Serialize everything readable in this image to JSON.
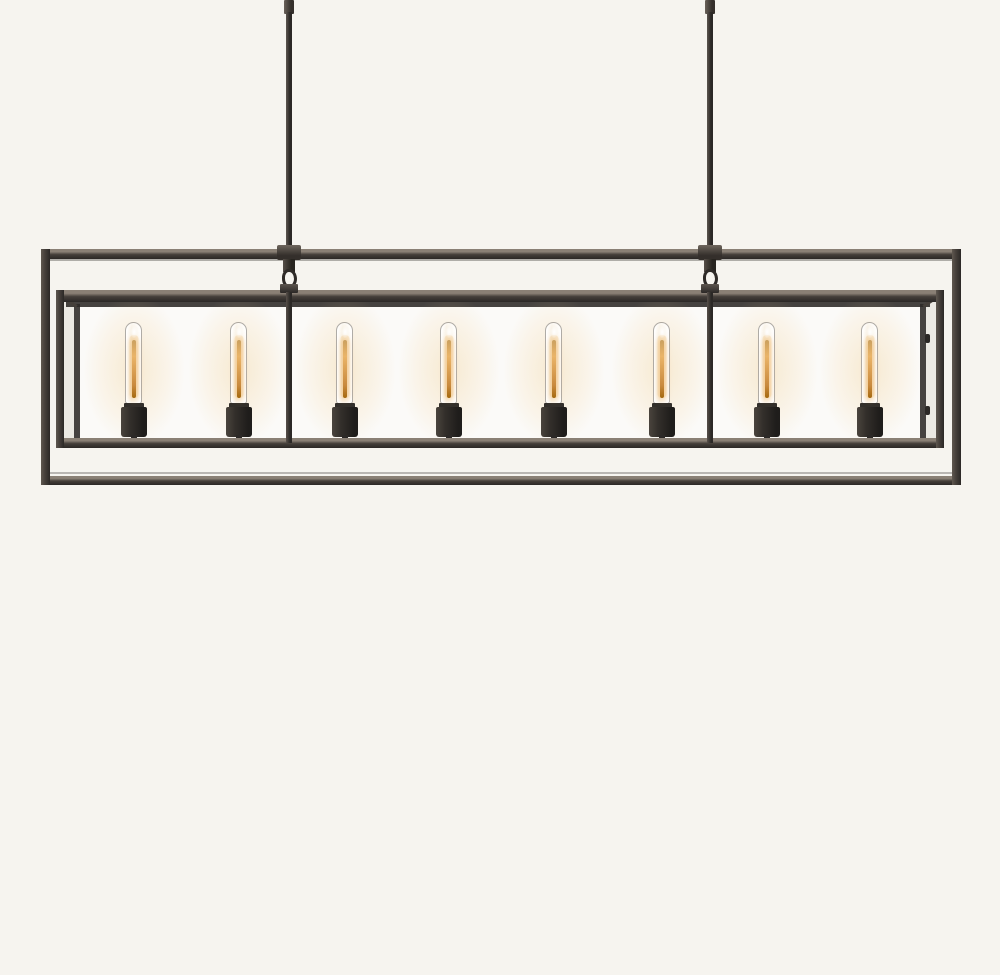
{
  "image": {
    "type": "product-photograph",
    "subject": "Eight-light linear box-frame chandelier with exposed tubular filament bulbs, dark bronze square-tube double frame with clear glass panels, suspended from two straight rods on a plain off-white backdrop",
    "background_color": "#f6f4ef"
  },
  "scene": {
    "colors": {
      "bg": "#f6f4ef",
      "metal-hi": "#8a8075",
      "metal-soft": "#5f5850",
      "metal-mid": "#453f3a",
      "metal-dark": "#2b2826",
      "glass-tint": "rgba(255,255,255,0.55)",
      "side-glass": "rgba(222,218,210,0.55)",
      "glow": "rgba(242,209,150,0.40)",
      "filament": "#c98a3e",
      "filament-bright": "#eab468",
      "glass-edge": "rgba(110,104,96,0.55)"
    },
    "lights": {
      "count": 8,
      "state": "on",
      "bulb_style": "clear tubular filament bulb in cylindrical black socket",
      "bulb_centers_x": [
        134,
        239,
        345,
        449,
        554,
        662,
        767,
        870
      ]
    },
    "rods": {
      "count": 2,
      "centers_x": [
        289,
        710
      ]
    }
  }
}
